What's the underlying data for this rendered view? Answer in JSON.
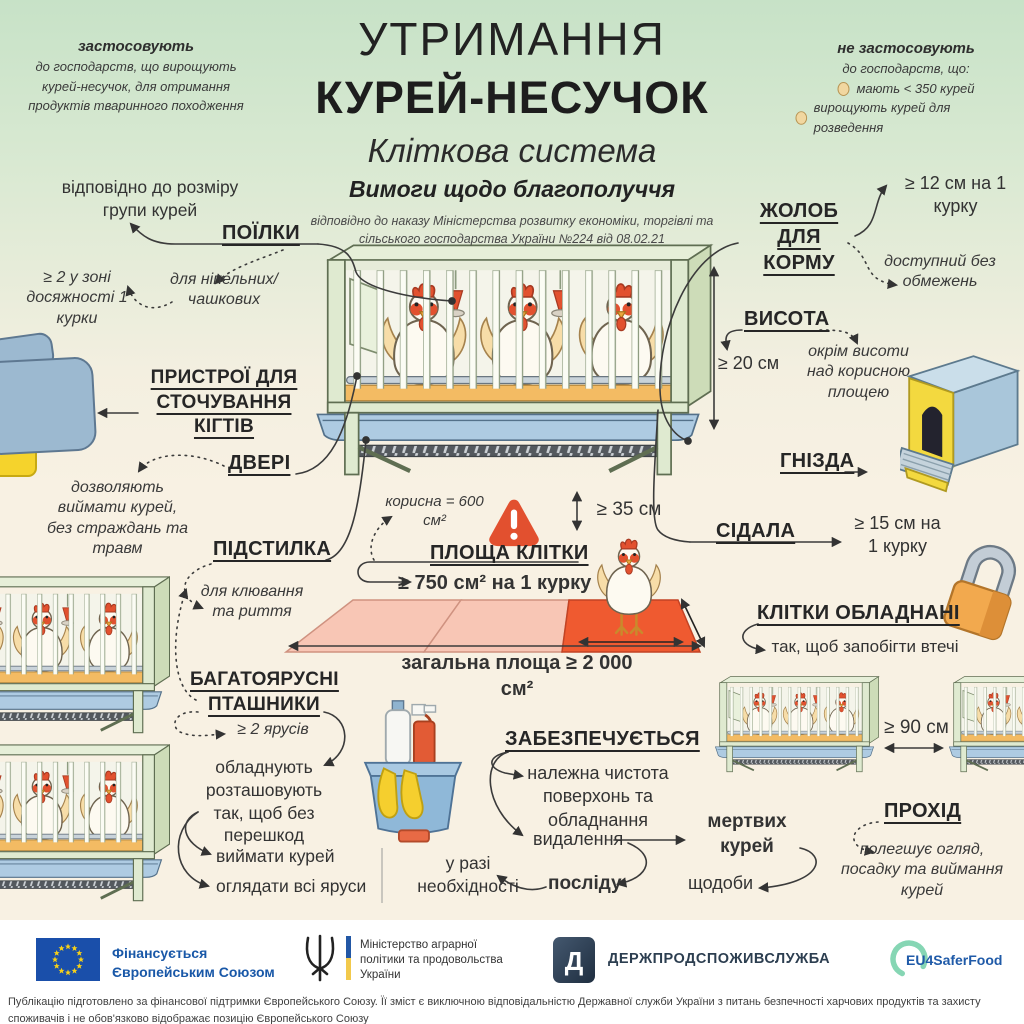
{
  "header": {
    "title1": "УТРИМАННЯ",
    "title2": "КУРЕЙ-НЕСУЧОК",
    "subtitle": "Кліткова система",
    "subtitle2": "Вимоги щодо благополуччя",
    "order": "відповідно до наказу Міністерства розвитку економіки, торгівлі та сільського господарства України №224 від 08.02.21",
    "apply": {
      "title": "застосовують",
      "text": "до господарств, що вирощують курей-несучок, для отримання продуктів тваринного походження"
    },
    "not_apply": {
      "title": "не застосовують",
      "subtitle": "до господарств, що:",
      "item1": "мають < 350 курей",
      "item2": "вирощують курей для розведення"
    }
  },
  "sections": {
    "poilky": {
      "heading": "ПОЇЛКИ",
      "group": "відповідно до розміру групи курей",
      "zone": "≥ 2 у зоні досяжності 1 курки",
      "types": "для ніпельних/ чашкових"
    },
    "claws": {
      "heading": "ПРИСТРОЇ ДЛЯ СТОЧУВАННЯ КІГТІВ"
    },
    "doors": {
      "heading": "ДВЕРІ",
      "note": "дозволяють виймати курей, без страждань та травм"
    },
    "litter": {
      "heading": "ПІДСТИЛКА",
      "note": "для клювання та риття"
    },
    "feeder": {
      "heading": "ЖОЛОБ ДЛЯ КОРМУ",
      "per_hen": "≥ 12 см на 1 курку",
      "access": "доступний без обмежень"
    },
    "height": {
      "heading": "ВИСОТА",
      "value": "≥ 20 см",
      "note": "окрім висоти над корисною площею"
    },
    "nests": {
      "heading": "ГНІЗДА"
    },
    "perches": {
      "heading": "СІДАЛА",
      "value": "≥ 15 см на 1 курку"
    },
    "area": {
      "heading": "ПЛОЩА КЛІТКИ",
      "useful": "корисна = 600 см²",
      "per_hen": "≥ 750 см² на 1 курку",
      "h35": "≥ 35 см",
      "total": "загальна площа ≥ 2 000 см²"
    },
    "equipped": {
      "heading": "КЛІТКИ ОБЛАДНАНІ",
      "note": "так, щоб запобігти втечі"
    },
    "multitier": {
      "heading": "БАГАТОЯРУСНІ ПТАШНИКИ",
      "tiers": "≥ 2 ярусів",
      "note": "обладнують розташовують так, щоб без перешкод",
      "item1": "виймати курей",
      "item2": "оглядати всі яруси"
    },
    "ensure": {
      "heading": "ЗАБЕЗПЕЧУЄТЬСЯ",
      "clean": "належна чистота поверхонь та обладнання",
      "removal": "видалення",
      "dead": "мертвих курей",
      "daily": "щодоби",
      "droppings": "посліду",
      "need": "у разі необхідності"
    },
    "aisle": {
      "heading": "ПРОХІД",
      "value": "≥ 90 см",
      "note": "полегшує огляд, посадку та виймання курей"
    }
  },
  "footer": {
    "eu": "Фінансується Європейським Союзом",
    "ministry": "Міністерство аграрної політики та продовольства України",
    "service": "ДЕРЖПРОДСПОЖИВСЛУЖБА",
    "eu4": "EU4SaferFood",
    "disclaimer": "Публікацію підготовлено за фінансової підтримки Європейського Союзу. Її зміст є виключною відповідальністю Державної служби України з питань безпечності харчових продуктів та захисту споживачів і не обов'язково відображає позицію Європейського Союзу"
  },
  "icons": {
    "egg-icon": "beige egg ellipse",
    "warning-icon": "red rounded triangle with white exclamation",
    "padlock-icon": "orange padlock with grey shackle",
    "eu-flag-icon": "blue flag with 12 yellow stars",
    "trident-icon": "ukrainian trident emblem",
    "service-logo-icon": "dark navy D monogram",
    "eu4saferfood-icon": "mint green open circle"
  },
  "colors": {
    "bg_top": "#c7e2c7",
    "bg_cream": "#f8f1e3",
    "accent_red": "#e2512f",
    "cage_green": "#dfead0",
    "trough_blue": "#aecbe2",
    "litter_orange": "#f3bb63",
    "tile_pink": "#f8c6b5",
    "eu_blue": "#1958a8",
    "footer_white": "#ffffff"
  }
}
